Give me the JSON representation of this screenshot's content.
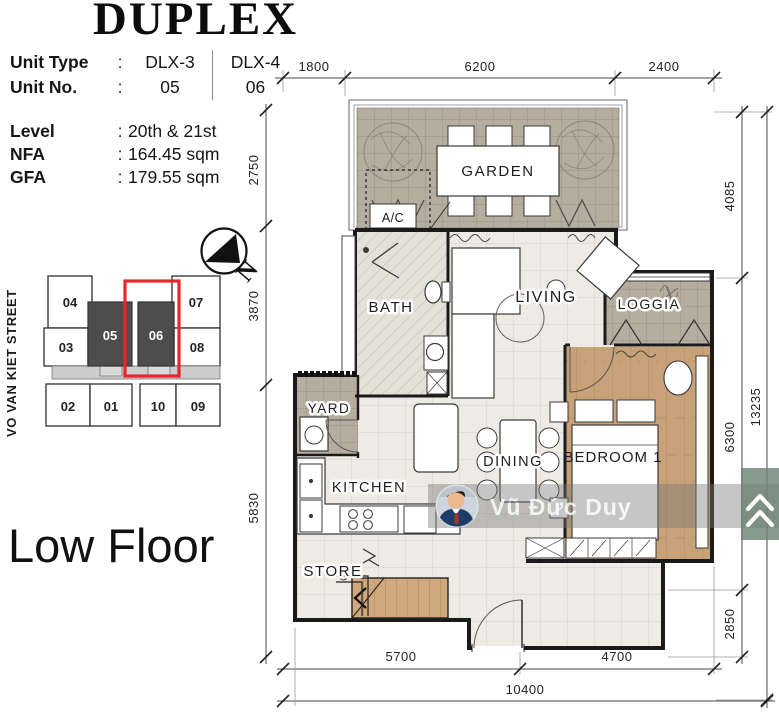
{
  "header": {
    "title": "DUPLEX"
  },
  "unit_table": {
    "rows": [
      {
        "label": "Unit Type",
        "colon": ":",
        "col1": "DLX-3",
        "col2": "DLX-4"
      },
      {
        "label": "Unit No.",
        "colon": ":",
        "col1": "05",
        "col2": "06"
      }
    ]
  },
  "info": {
    "rows": [
      {
        "label": "Level",
        "colon": ":",
        "value": "20th & 21st"
      },
      {
        "label": "NFA",
        "colon": ":",
        "value": "164.45 sqm"
      },
      {
        "label": "GFA",
        "colon": ":",
        "value": "179.55 sqm"
      }
    ]
  },
  "floor_label": "Low Floor",
  "street_label": "VO VAN KIET STREET",
  "north": {
    "label": "N"
  },
  "key_plan": {
    "highlighted_unit": "06",
    "highlight_color": "#e8262b",
    "dark_unit_color": "#4d4d4d",
    "units": [
      {
        "id": "04"
      },
      {
        "id": "07"
      },
      {
        "id": "03"
      },
      {
        "id": "05",
        "variant": "dark"
      },
      {
        "id": "06",
        "variant": "dark",
        "highlighted": true
      },
      {
        "id": "08"
      },
      {
        "id": "02"
      },
      {
        "id": "01"
      },
      {
        "id": "10"
      },
      {
        "id": "09"
      }
    ]
  },
  "rooms": {
    "garden": "GARDEN",
    "ac": "A/C",
    "bath": "BATH",
    "living": "LIVING",
    "loggia": "LOGGIA",
    "yard": "YARD",
    "dining": "DINING",
    "bedroom1": "BEDROOM 1",
    "kitchen": "KITCHEN",
    "store": "STORE"
  },
  "dimensions": {
    "top": [
      "1800",
      "6200",
      "2400"
    ],
    "left": [
      "2750",
      "3870",
      "5830"
    ],
    "right_inner": [
      "4085",
      "6300",
      "2850"
    ],
    "right_outer": [
      "13235"
    ],
    "bottom_inner": [
      "5700",
      "4700"
    ],
    "bottom_outer": [
      "10400"
    ]
  },
  "watermark": {
    "name": "Vũ Đức Duy",
    "logo": "double-chevron-home-icon",
    "band_color": "rgba(120,120,120,0.42)",
    "logo_color": "#6e8374"
  }
}
